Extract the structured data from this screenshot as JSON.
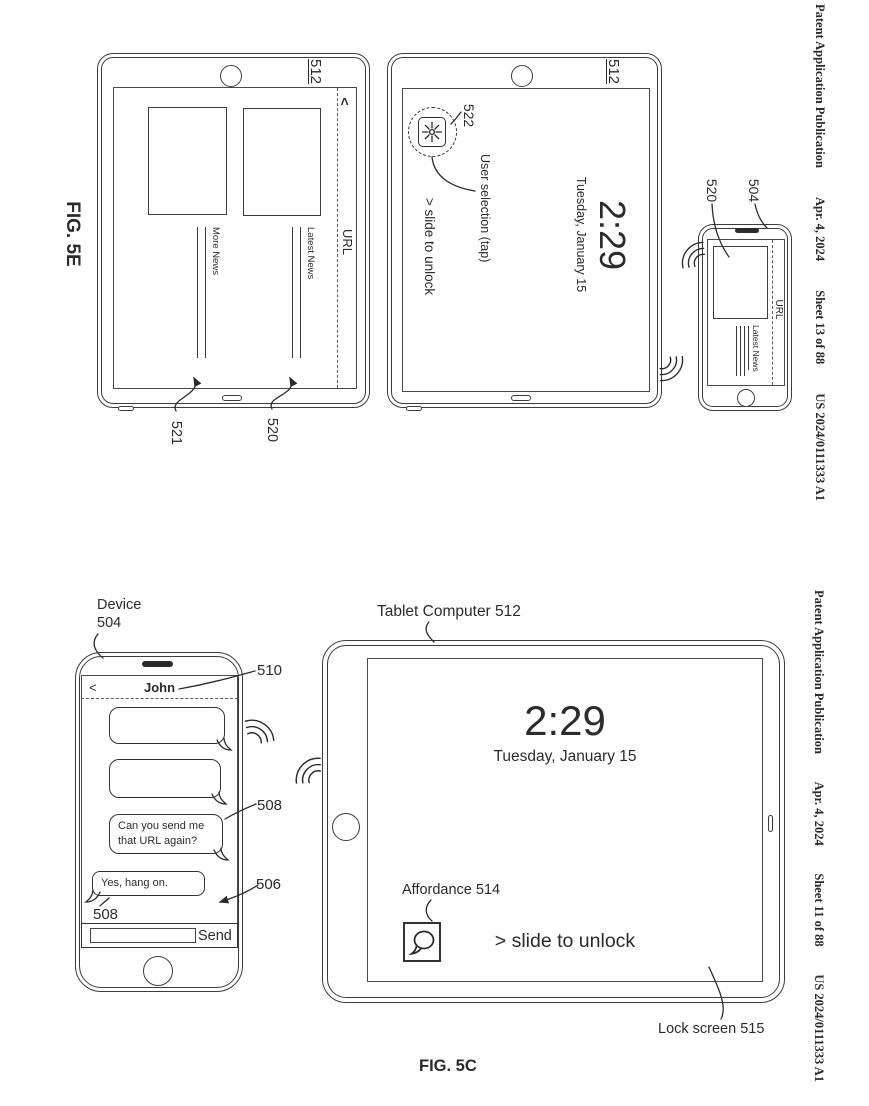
{
  "headers": {
    "top": {
      "publication": "Patent Application Publication",
      "date": "Apr. 4, 2024",
      "sheet": "Sheet 13 of 88",
      "number": "US 2024/0111333 A1"
    },
    "bottom": {
      "publication": "Patent Application Publication",
      "date": "Apr. 4, 2024",
      "sheet": "Sheet 11 of 88",
      "number": "US 2024/0111333 A1"
    }
  },
  "fig5e": {
    "label": "FIG. 5E",
    "tablet_news": {
      "ref": "512",
      "back_glyph": "<",
      "url_label": "URL",
      "item_left": {
        "title": "More News",
        "callout": "521"
      },
      "item_right": {
        "title": "Latest News",
        "callout": "520"
      }
    },
    "tablet_lock": {
      "ref": "512",
      "time": "2:29",
      "date": "Tuesday, January 15",
      "slide_text": "> slide to unlock",
      "icon_callout": "522",
      "selection_note": "User selection (tap)"
    },
    "phone": {
      "ref": "504",
      "image_callout": "520",
      "url_label": "URL",
      "item_title": "Latest News"
    }
  },
  "fig5c": {
    "label": "FIG. 5C",
    "phone": {
      "device_label": "Device",
      "device_ref": "504",
      "header_callout": "510",
      "back_glyph": "<",
      "contact_name": "John",
      "incoming_message": {
        "line1": "Can you send me",
        "line2": "that URL again?",
        "callout": "508"
      },
      "outgoing_message": {
        "text": "Yes, hang on.",
        "callout": "508"
      },
      "screen_callout": "506",
      "send_label": "Send"
    },
    "tablet": {
      "label": "Tablet Computer 512",
      "time": "2:29",
      "date": "Tuesday, January 15",
      "affordance_label": "Affordance 514",
      "slide_text": "> slide to unlock",
      "lock_label": "Lock screen 515"
    }
  }
}
